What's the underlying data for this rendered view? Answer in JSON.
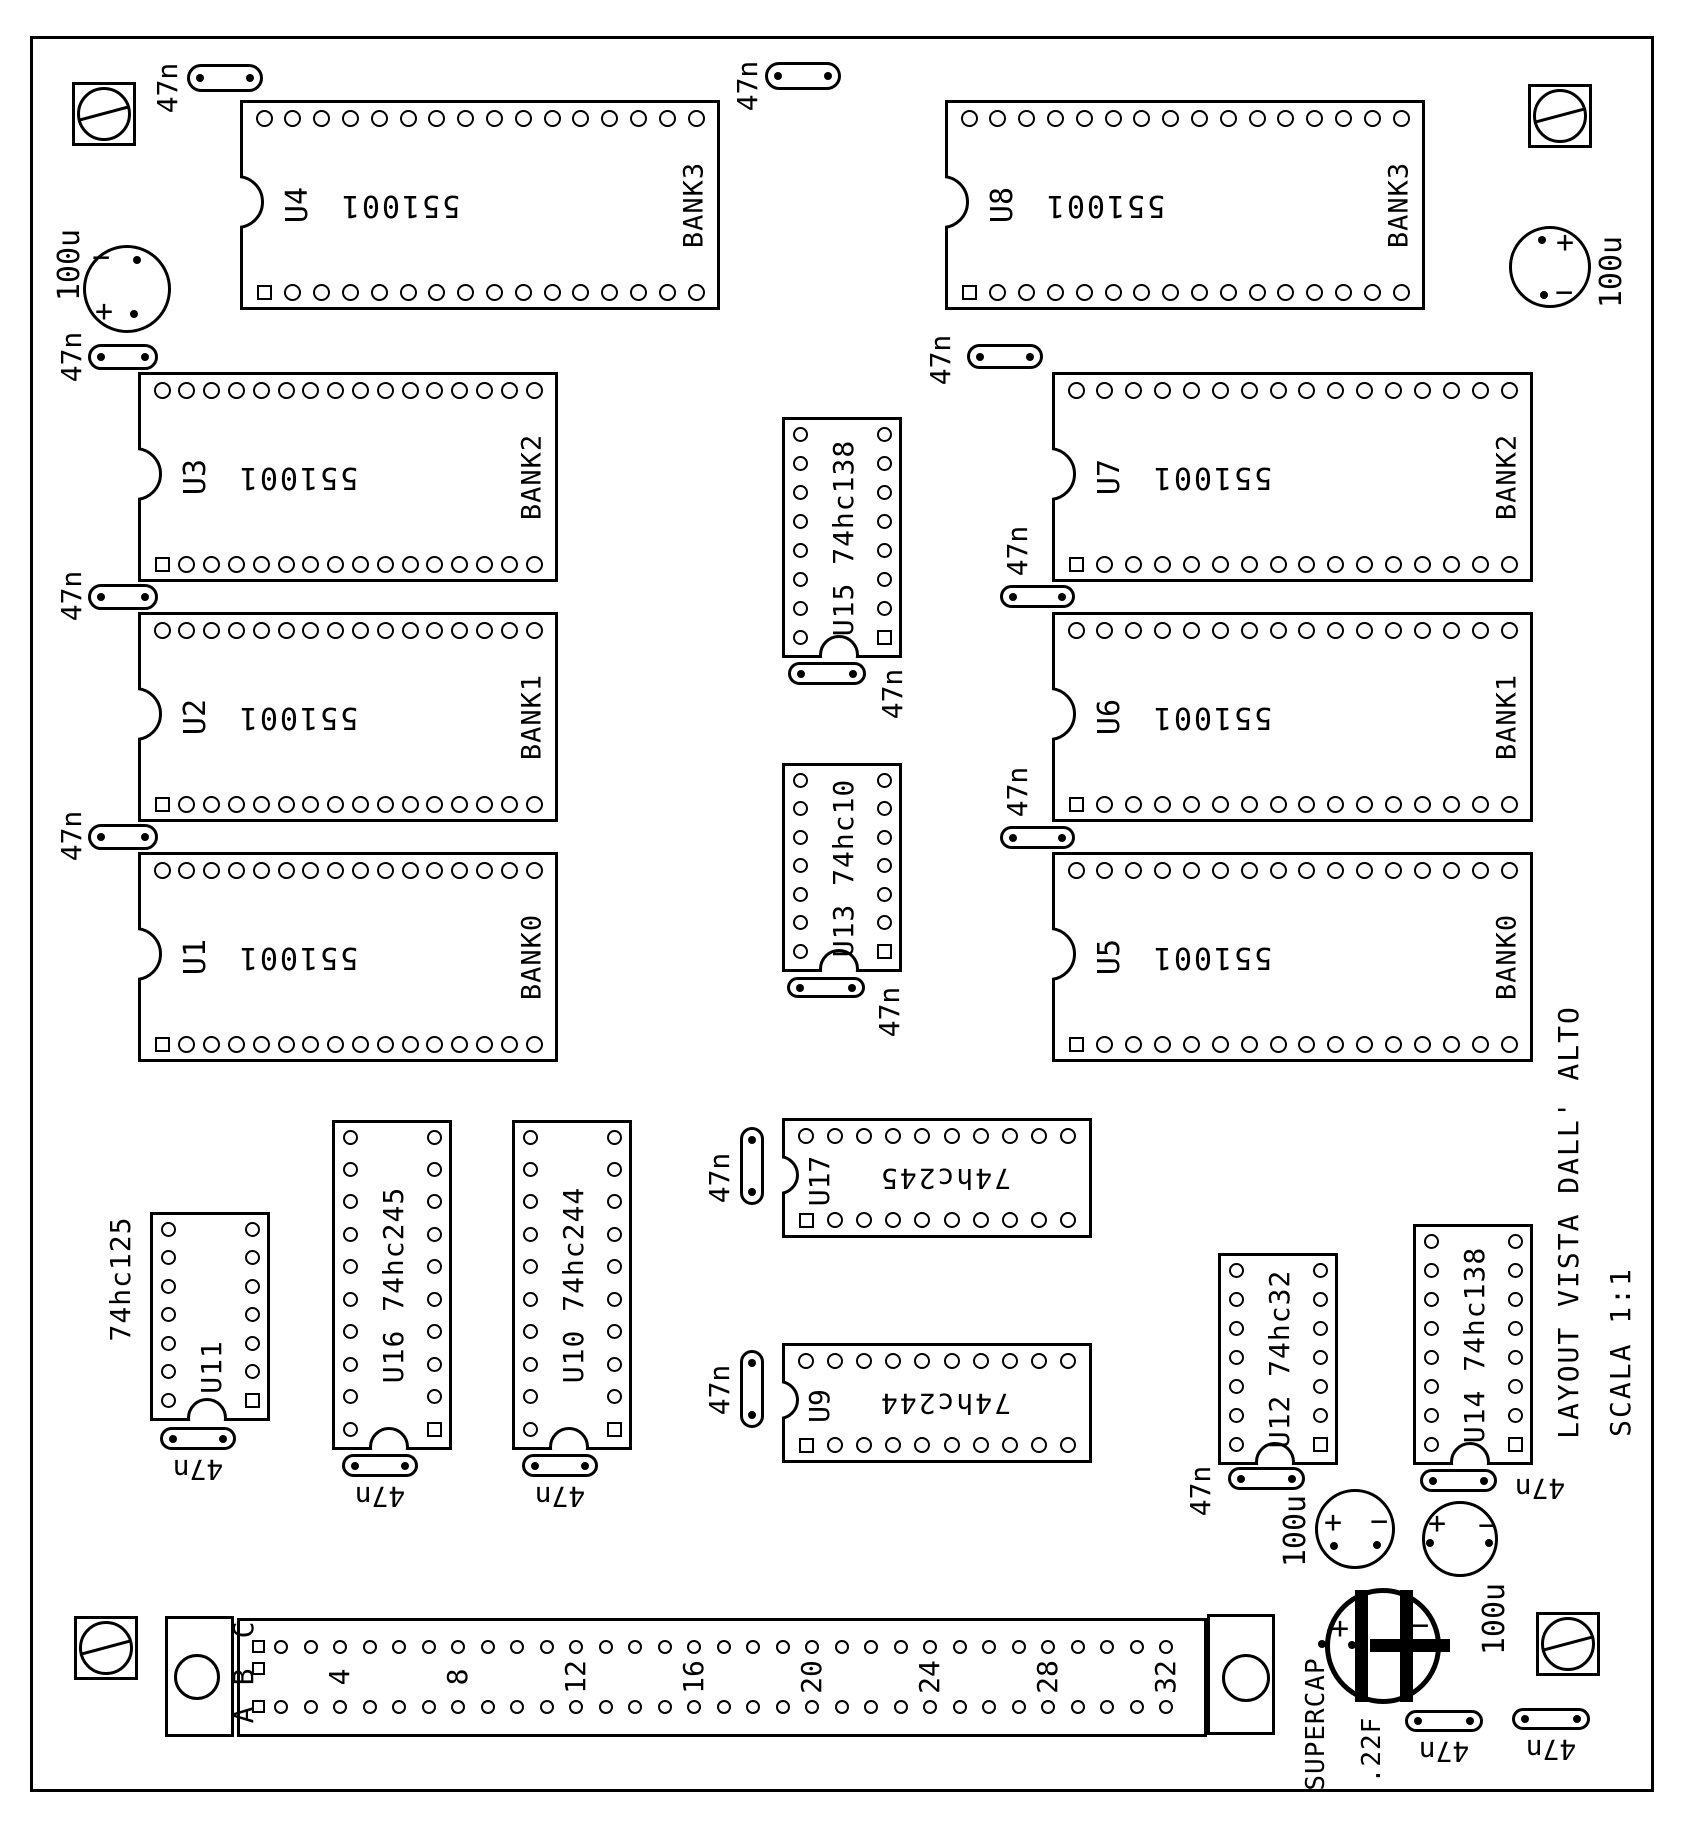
{
  "title": {
    "main": "LAYOUT VISTA DALL' ALTO",
    "scale": "SCALA 1:1"
  },
  "chips": [
    {
      "id": "U4",
      "part": "551001",
      "bank": "BANK3"
    },
    {
      "id": "U3",
      "part": "551001",
      "bank": "BANK2"
    },
    {
      "id": "U2",
      "part": "551001",
      "bank": "BANK1"
    },
    {
      "id": "U1",
      "part": "551001",
      "bank": "BANK0"
    },
    {
      "id": "U8",
      "part": "551001",
      "bank": "BANK3"
    },
    {
      "id": "U7",
      "part": "551001",
      "bank": "BANK2"
    },
    {
      "id": "U6",
      "part": "551001",
      "bank": "BANK1"
    },
    {
      "id": "U5",
      "part": "551001",
      "bank": "BANK0"
    },
    {
      "id": "U17",
      "part": "74hc245"
    },
    {
      "id": "U9",
      "part": "74hc244"
    },
    {
      "id": "U15",
      "part": "74hc138",
      "label": "U15 74hc138"
    },
    {
      "id": "U13",
      "part": "74hc10",
      "label": "U13 74hc10"
    },
    {
      "id": "U11",
      "part": "74hc125",
      "label": "U11",
      "part_label": "74hc125"
    },
    {
      "id": "U16",
      "part": "74hc245",
      "label": "U16 74hc245"
    },
    {
      "id": "U10",
      "part": "74hc244",
      "label": "U10 74hc244"
    },
    {
      "id": "U12",
      "part": "74hc32",
      "label": "U12 74hc32"
    },
    {
      "id": "U14",
      "part": "74hc138",
      "label": "U14 74hc138"
    }
  ],
  "capacitor_47n": {
    "value": "47n",
    "count": 19
  },
  "capacitor_100u": {
    "value": "100u",
    "count": 4,
    "plus": "+",
    "minus": "−"
  },
  "supercap": {
    "name": "SUPERCAP",
    "value": ".22F",
    "plus": "+",
    "minus": "−"
  },
  "connector": {
    "row_labels": [
      "C",
      "B",
      "A"
    ],
    "pin_numbers": [
      "4",
      "8",
      "12",
      "16",
      "20",
      "24",
      "28",
      "32"
    ]
  }
}
